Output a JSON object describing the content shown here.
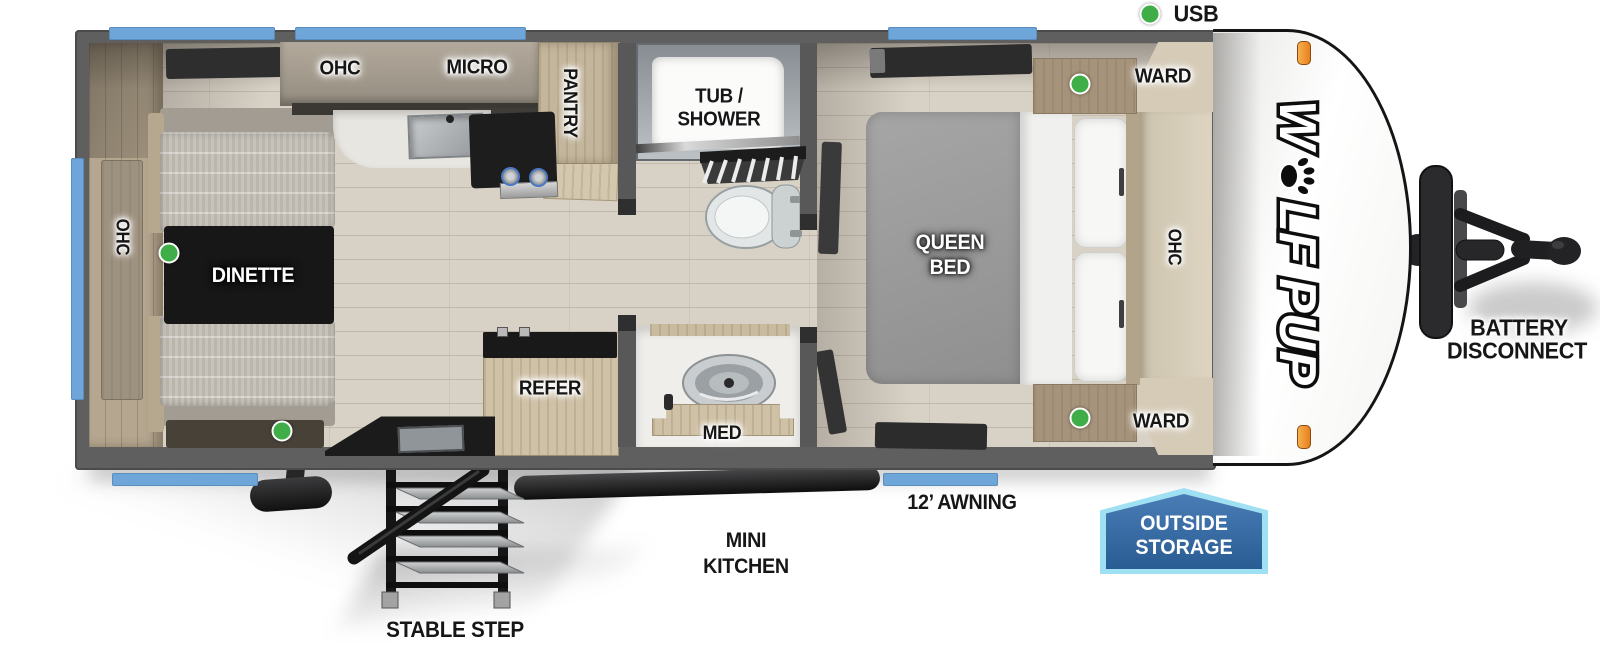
{
  "canvas": {
    "width": 1600,
    "height": 660,
    "description": "Top-down RV travel trailer floor plan"
  },
  "colors": {
    "window_blue": "#6fa6d9",
    "wall_gray": "#5f5f5f",
    "indicator_green": "#3fae49",
    "marker_light_orange": "#f09c3c",
    "badge_fill_blue": "#2f6aa5",
    "badge_border_blue": "#9fe0f2"
  },
  "brand": {
    "logo_first": "W",
    "logo_rest": "LF PUP"
  },
  "exterior": {
    "usb": "USB",
    "battery_line1": "BATTERY",
    "battery_line2": "DISCONNECT",
    "awning": "12’ AWNING",
    "mini_kitchen_line1": "MINI",
    "mini_kitchen_line2": "KITCHEN",
    "stable_step": "STABLE STEP",
    "outside_storage_line1": "OUTSIDE",
    "outside_storage_line2": "STORAGE"
  },
  "dinette": {
    "ohc": "OHC",
    "table": "DINETTE"
  },
  "kitchen": {
    "ohc": "OHC",
    "micro": "MICRO",
    "pantry": "PANTRY",
    "refer": "REFER"
  },
  "bathroom": {
    "tub_line1": "TUB /",
    "tub_line2": "SHOWER",
    "med": "MED"
  },
  "bedroom": {
    "bed_line1": "QUEEN",
    "bed_line2": "BED",
    "ward_rear": "WARD",
    "ward_front": "WARD",
    "ohc": "OHC"
  }
}
